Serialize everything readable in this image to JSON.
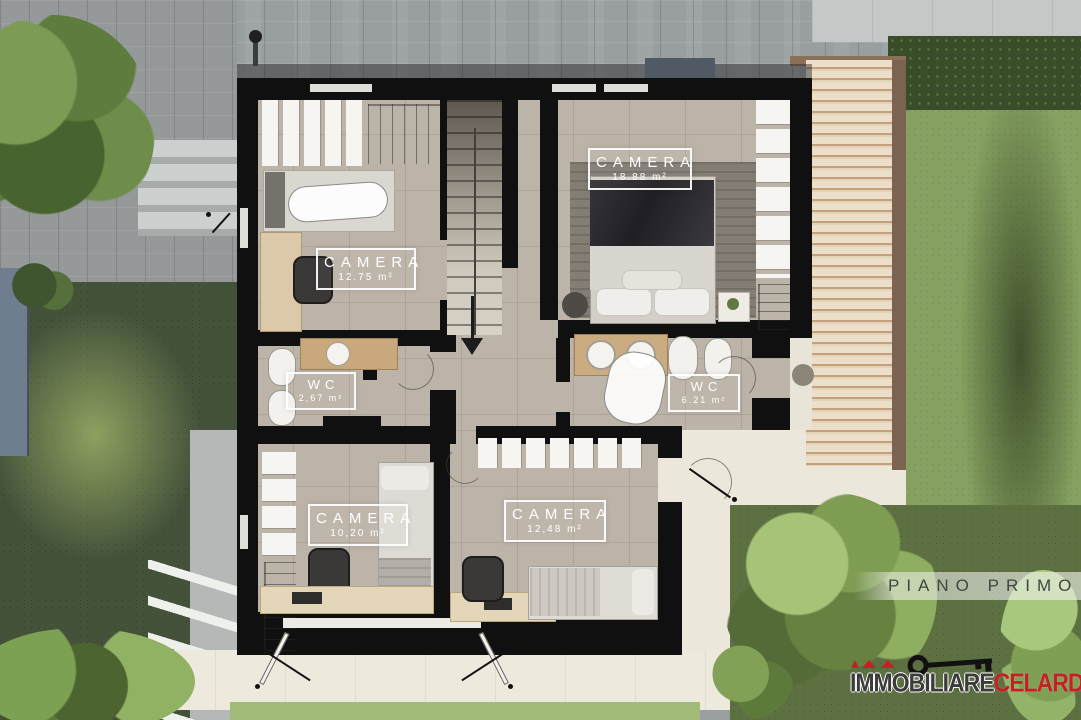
{
  "floor_band": {
    "label": "PIANO PRIMO"
  },
  "rooms": [
    {
      "name": "CAMERA",
      "area": "12.75 m²"
    },
    {
      "name": "CAMERA",
      "area": "18.88 m²"
    },
    {
      "name": "WC",
      "area": "2,67 m²"
    },
    {
      "name": "WC",
      "area": "6.21 m²"
    },
    {
      "name": "CAMERA",
      "area": "10,20 m²"
    },
    {
      "name": "CAMERA",
      "area": "12,48 m²"
    }
  ],
  "watermark": {
    "brand_black": "IMMOBILIARE",
    "brand_red": "CELARDO"
  },
  "colors": {
    "wall": "#101010",
    "floor": "#bcb4a8",
    "terrace": "#ece7db",
    "pergola_wood": "#e4d3b6",
    "lawn_dark": "#44523a",
    "lawn_light": "#86a161",
    "brand_red": "#c62026",
    "label_white": "#ffffff"
  }
}
